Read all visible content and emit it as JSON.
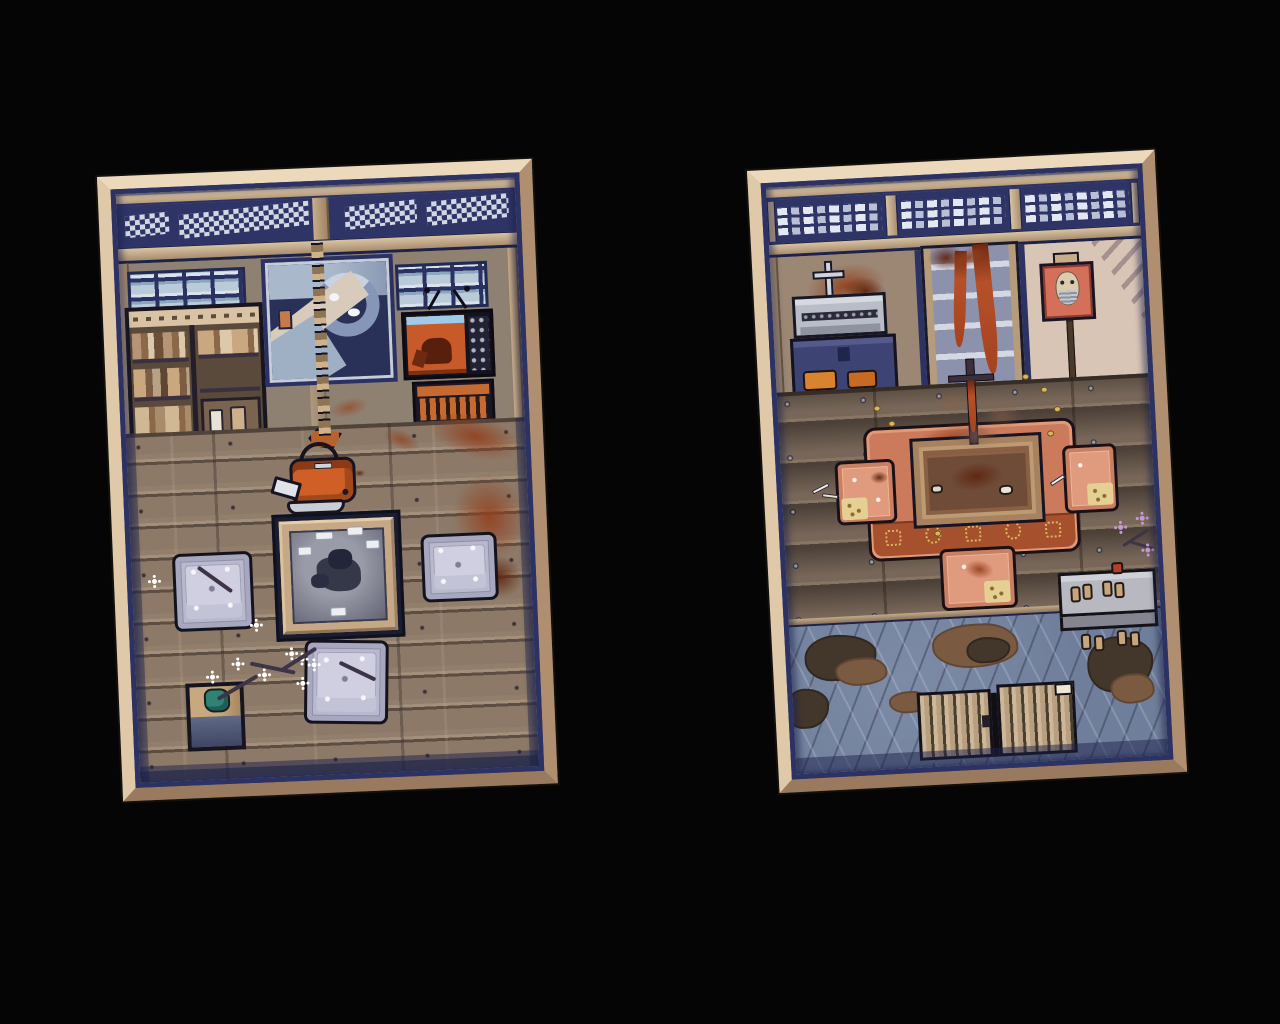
{
  "scene": {
    "type": "pixel-art top-down rooms, game screenshot",
    "background_color": "#050505",
    "panels": [
      {
        "id": "left-room",
        "label": "sitting room with irori hearth",
        "items": [
          {
            "name": "transom-lattice"
          },
          {
            "name": "window-left"
          },
          {
            "name": "bookshelf"
          },
          {
            "name": "wave-painting"
          },
          {
            "name": "pot-hook-chain"
          },
          {
            "name": "window-right"
          },
          {
            "name": "television"
          },
          {
            "name": "tv-stand"
          },
          {
            "name": "hanging-kettle"
          },
          {
            "name": "irori-hearth"
          },
          {
            "name": "floor-cushion",
            "count": 3
          },
          {
            "name": "plant-stand"
          },
          {
            "name": "blossom-branch"
          },
          {
            "name": "blood-smears"
          }
        ]
      },
      {
        "id": "right-room",
        "label": "dining room with genkan entrance",
        "items": [
          {
            "name": "transom-lattice"
          },
          {
            "name": "altar-desk"
          },
          {
            "name": "cross-statue"
          },
          {
            "name": "blood-splatter"
          },
          {
            "name": "bloody-shelf"
          },
          {
            "name": "framed-mask"
          },
          {
            "name": "hanging-pole"
          },
          {
            "name": "dining-table"
          },
          {
            "name": "rug"
          },
          {
            "name": "floor-cushion",
            "count": 3
          },
          {
            "name": "gold-coins"
          },
          {
            "name": "purple-blossoms"
          },
          {
            "name": "shoe-step"
          },
          {
            "name": "sandals"
          },
          {
            "name": "stone-floor"
          },
          {
            "name": "mud-stains"
          },
          {
            "name": "entrance-door"
          }
        ]
      }
    ]
  },
  "palette": {
    "background": "#050505",
    "frame": "#c9a98a",
    "frame_light": "#ecd8ba",
    "frame_dark": "#9a7a5e",
    "trim_navy": "#2c3263",
    "wall_gray": "#8f8172",
    "wood_post": "#b79c7c",
    "wall_cream": "#d9c5b5",
    "floor_left": "#8c7968",
    "floor_right": "#786759",
    "stone_floor": "#6f7e9a",
    "cushion_lavender": "#b9b9ce",
    "cushion_salmon": "#e09a7e",
    "cushion_patch": "#e5cf93",
    "rug": "#cc7a5c",
    "rug_border": "#a6502e",
    "gold": "#d9b85c",
    "blood": "#93401d",
    "kettle_orange": "#cf5f26",
    "tv_screen": "#c75a28",
    "ash_gray": "#8c8d9c",
    "charcoal": "#353848",
    "plant_teal": "#2f8274",
    "painting_navy": "#2a3158",
    "painting_blue": "#8696b8",
    "painting_cream": "#d8cbbb",
    "purple_flower": "#c59ad2"
  }
}
